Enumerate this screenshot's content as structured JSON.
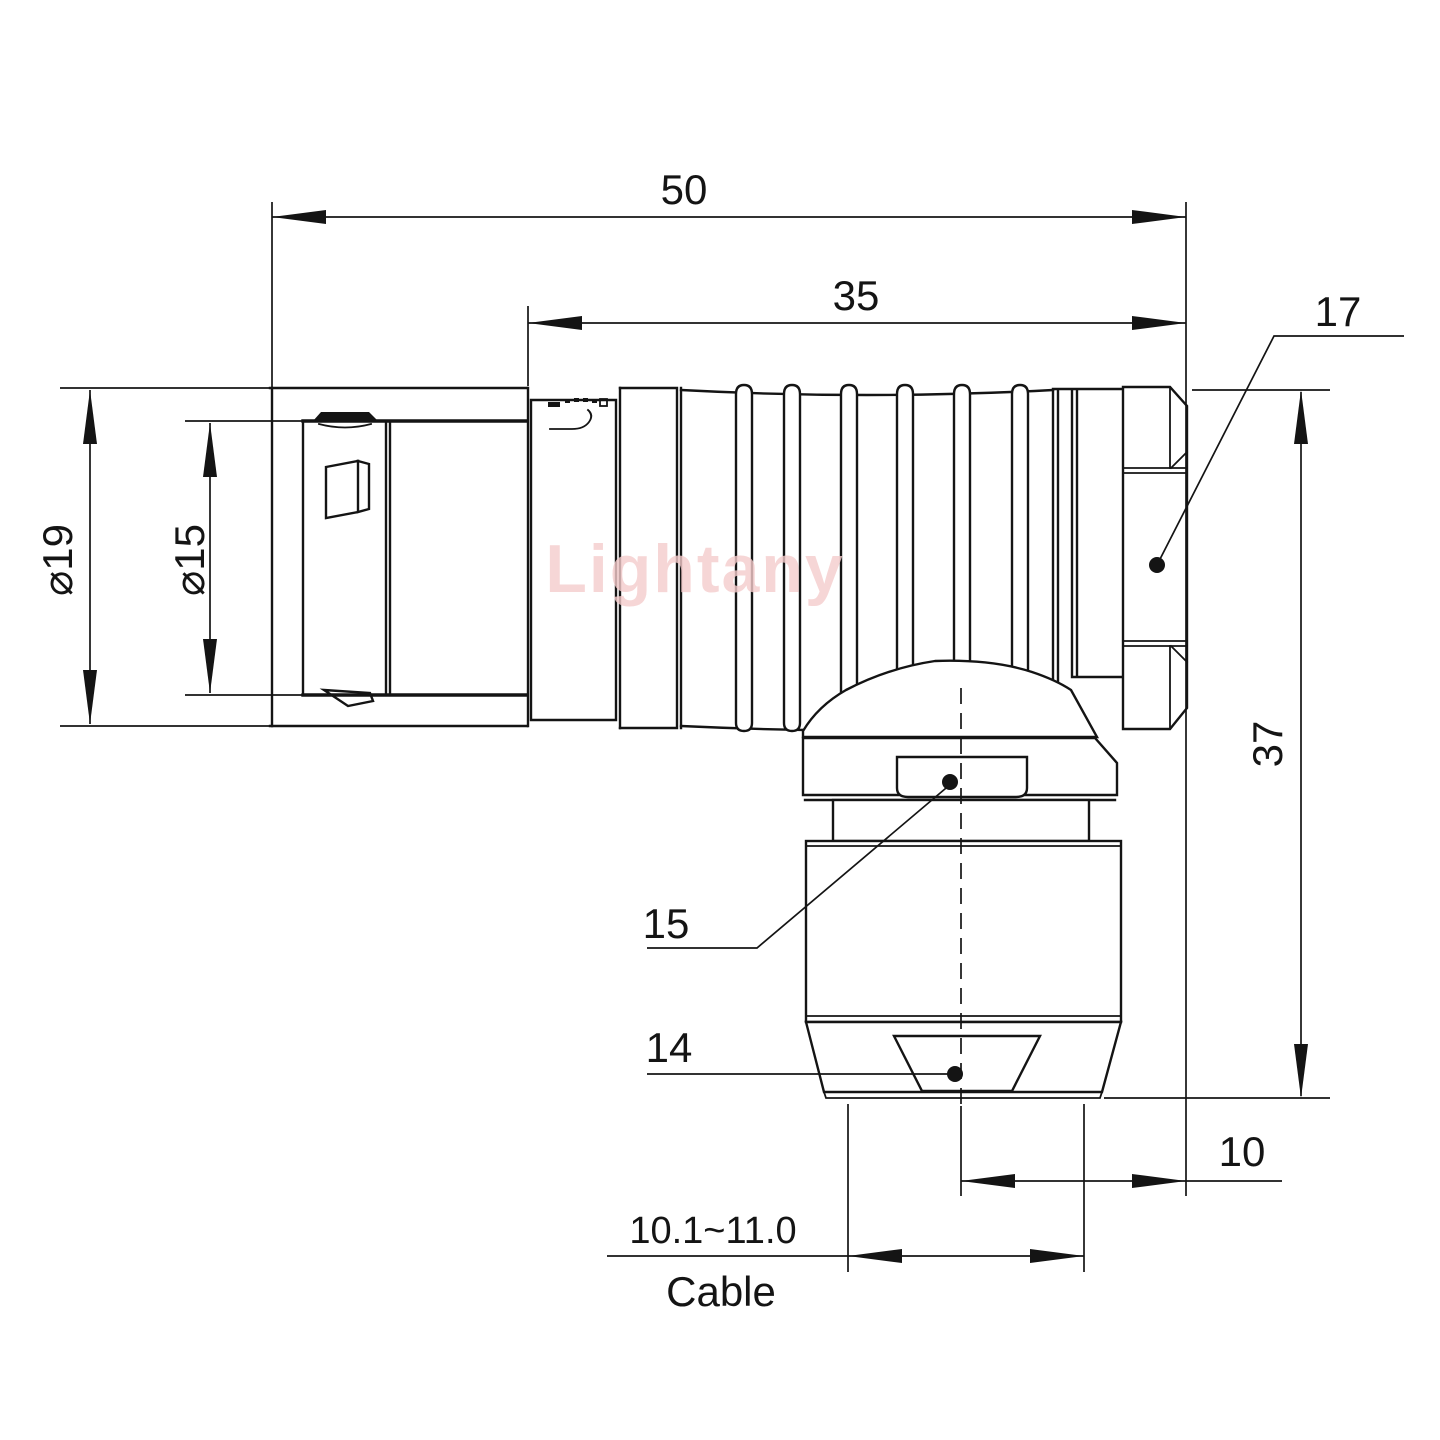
{
  "watermark": {
    "text": "Lightany",
    "color": "#f5cccc"
  },
  "colors": {
    "line": "#141414",
    "background": "#ffffff"
  },
  "dimensions": {
    "overall_length": "50",
    "front_length": "35",
    "hex_across_flats": "17",
    "outer_diameter": "⌀19",
    "sleeve_diameter": "⌀15",
    "elbow_height": "37",
    "gland_nut_size": "15",
    "collet_size": "14",
    "axis_to_face": "10",
    "cable_range": "10.1~11.0",
    "cable_label": "Cable"
  }
}
